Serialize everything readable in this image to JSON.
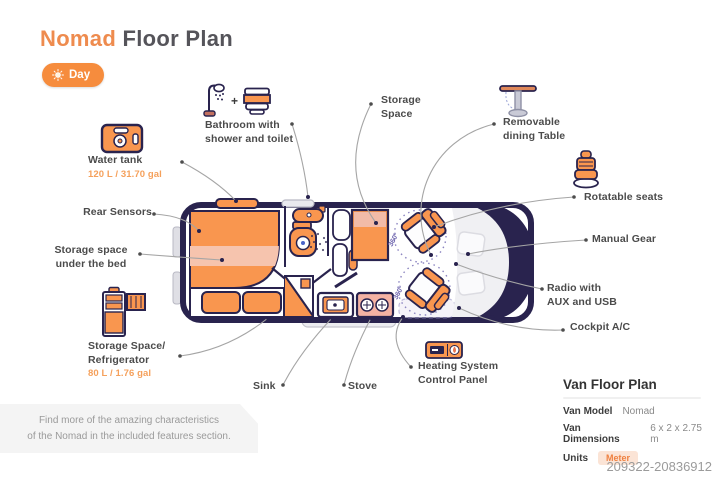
{
  "header": {
    "title_accent": "Nomad",
    "title_rest": " Floor Plan",
    "day_button": "Day"
  },
  "callouts": {
    "water_tank": {
      "label": "Water tank",
      "value": "120 L / 31.70 gal"
    },
    "bathroom": {
      "line1": "Bathroom with",
      "line2": "shower and toilet",
      "plus": "+"
    },
    "storage_space": {
      "line1": "Storage",
      "line2": "Space"
    },
    "dining_table": {
      "line1": "Removable",
      "line2": "dining Table"
    },
    "rotatable_seats": {
      "label": "Rotatable seats"
    },
    "manual_gear": {
      "label": "Manual Gear"
    },
    "radio": {
      "line1": "Radio with",
      "line2": "AUX and USB"
    },
    "cockpit_ac": {
      "label": "Cockpit A/C"
    },
    "rear_sensors": {
      "label": "Rear Sensors"
    },
    "under_bed": {
      "line1": "Storage space",
      "line2": "under the bed"
    },
    "fridge": {
      "line1": "Storage Space/",
      "line2": "Refrigerator",
      "value": "80 L / 1.76 gal"
    },
    "sink": {
      "label": "Sink"
    },
    "stove": {
      "label": "Stove"
    },
    "heating": {
      "line1": "Heating System",
      "line2": "Control Panel"
    }
  },
  "floor_plan": {
    "rotation_label": "360°"
  },
  "info_panel": {
    "title": "Van Floor Plan",
    "rows": [
      {
        "label": "Van Model",
        "value": "Nomad"
      },
      {
        "label": "Van Dimensions",
        "value": "6 x 2 x 2.75 m"
      },
      {
        "label": "Units",
        "value": "Meter"
      }
    ]
  },
  "footer_note": {
    "line1": "Find more of the amazing characteristics",
    "line2": "of the Nomad in the included features section."
  },
  "watermark": "209322-20836912",
  "colors": {
    "accent_orange": "#F68C3D",
    "furniture_orange": "#F9964F",
    "navy_outline": "#29234E",
    "pink_fill": "#F6C4AE",
    "value_text": "#F5A05B",
    "badge_bg": "#FBE4D6",
    "leader_line": "#A5A5A5"
  }
}
